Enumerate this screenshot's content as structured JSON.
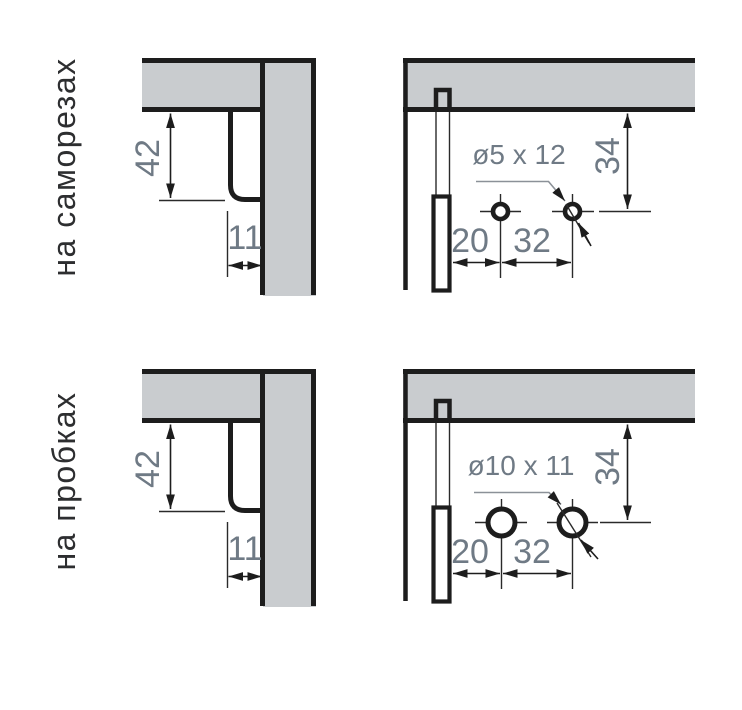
{
  "rows": [
    {
      "label": "на саморезах",
      "side_view": {
        "vertical_dim": "42",
        "horizontal_dim": "11"
      },
      "front_view": {
        "hole_label": "ø5 x 12",
        "top_dim": "34",
        "edge_dim": "20",
        "pitch_dim": "32"
      }
    },
    {
      "label": "на пробках",
      "side_view": {
        "vertical_dim": "42",
        "horizontal_dim": "11"
      },
      "front_view": {
        "hole_label": "ø10 x 11",
        "top_dim": "34",
        "edge_dim": "20",
        "pitch_dim": "32"
      }
    }
  ],
  "colors": {
    "background": "#ffffff",
    "outline": "#1d1d1d",
    "panel_fill": "#c9cccf",
    "dimension_text": "#6f7a85",
    "row_label_text": "#2d2e30",
    "leader_line": "#8b9198"
  }
}
